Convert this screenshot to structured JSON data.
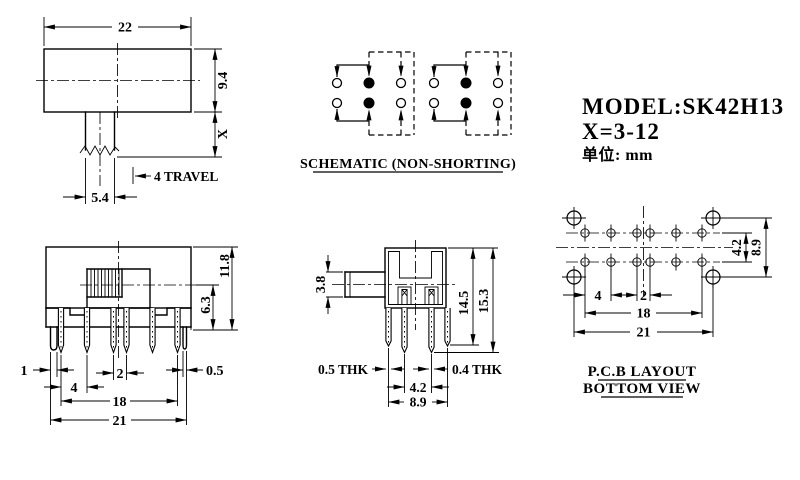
{
  "drawing": {
    "info": {
      "model": "MODEL:SK42H13",
      "x_range": "X=3-12",
      "unit_label": "单位: mm"
    },
    "top_view": {
      "body_width": "22",
      "body_height": "9.4",
      "shaft_height": "X",
      "stem_width": "5.4",
      "travel": "4 TRAVEL"
    },
    "schematic": {
      "title": "SCHEMATIC (NON-SHORTING)"
    },
    "front_view": {
      "overall_height": "11.8",
      "body_height": "6.3",
      "left_leg_width": "1",
      "pin_pitch": "4",
      "center_pitch": "2",
      "right_leg_width": "0.5",
      "pin_span": "18",
      "leg_span": "21"
    },
    "side_view": {
      "knob_height": "3.8",
      "outer_pin_length": "14.5",
      "overall_length": "15.3",
      "thickness_left": "0.5 THK",
      "thickness_right": "0.4 THK",
      "center_gap": "4.2",
      "outer_gap": "8.9"
    },
    "pcb": {
      "title_line1": "P.C.B LAYOUT",
      "title_line2": "BOTTOM VIEW",
      "row_gap": "4.2",
      "hole_row_gap": "8.9",
      "pad_pitch": "4",
      "center_pitch": "2",
      "pad_span": "18",
      "hole_span": "21"
    }
  }
}
